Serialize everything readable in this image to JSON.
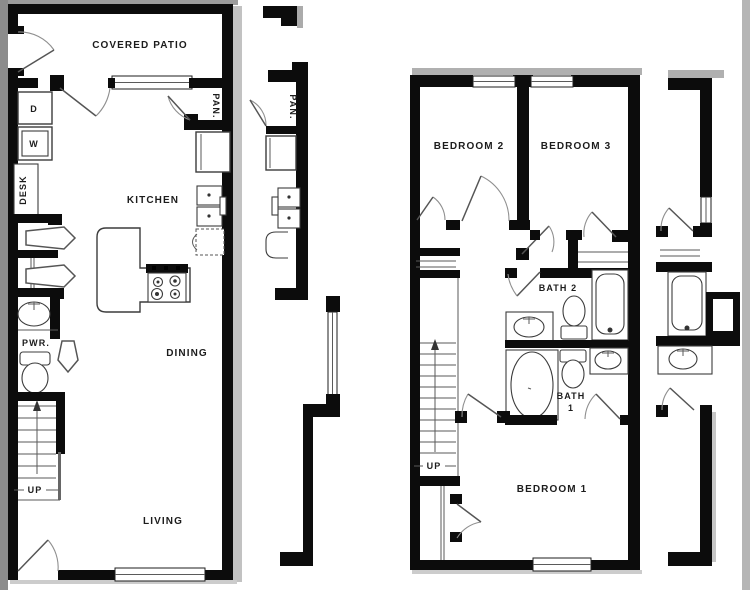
{
  "plan": {
    "first_floor": {
      "rooms": {
        "covered_patio": "COVERED PATIO",
        "kitchen": "KITCHEN",
        "dining": "DINING",
        "living": "LIVING",
        "powder": "PWR.",
        "pantry": "PAN.",
        "desk": "DESK"
      },
      "appliances": {
        "dryer": "D",
        "washer": "W"
      },
      "stairs_label": "UP"
    },
    "adjacent_first_floor": {
      "pantry": "PAN."
    },
    "second_floor": {
      "rooms": {
        "bedroom1": "BEDROOM 1",
        "bedroom2": "BEDROOM 2",
        "bedroom3": "BEDROOM 3",
        "bath1_line1": "BATH",
        "bath1_line2": "1",
        "bath2": "BATH 2"
      },
      "stairs_label": "UP"
    },
    "colors": {
      "wall": "#0c0c0c",
      "background": "#ffffff",
      "fixture_line": "#3c3c3c",
      "shadow": "#bdbdbd",
      "edge_band_left": "#8c8c8c",
      "edge_band_right": "#b5b5b5"
    }
  }
}
